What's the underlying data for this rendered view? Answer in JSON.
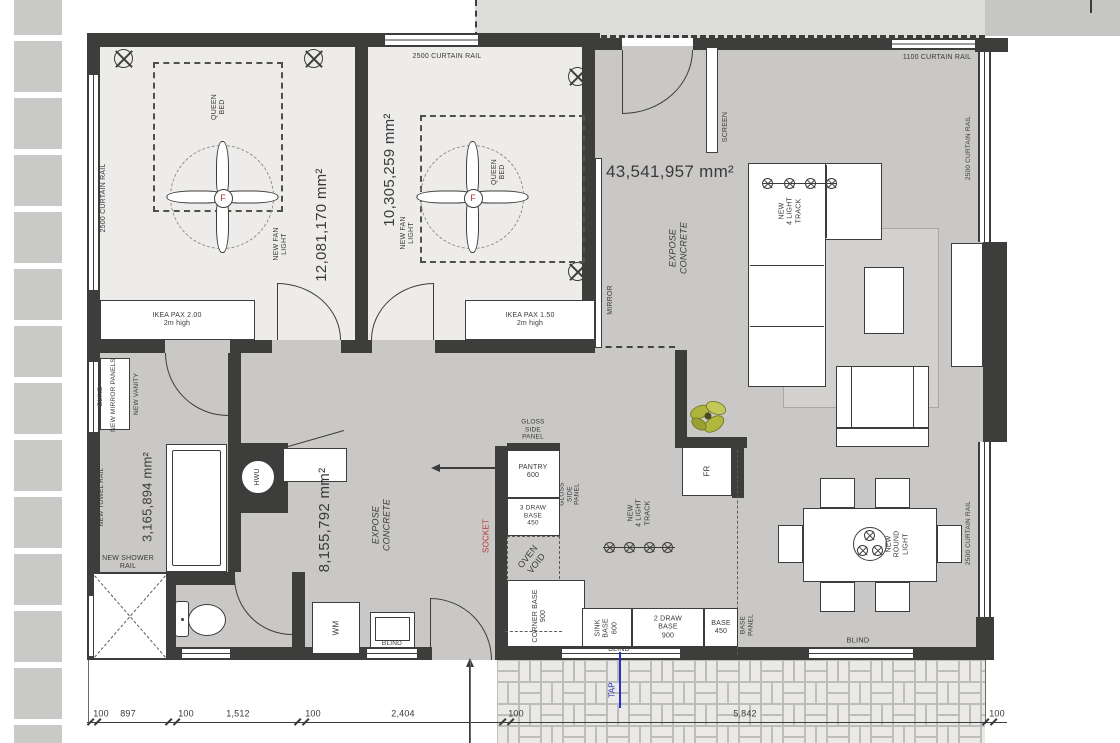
{
  "colors": {
    "wall": "#3d3d3b",
    "floor_main": "#c9c8c6",
    "floor_bedroom": "#edecea",
    "deck": "#dcdcda",
    "accent_red": "#c03330",
    "accent_blue": "#2433c0"
  },
  "rooms": {
    "bedroom1": {
      "area": "12,081,170 mm²",
      "bed": "QUEEN\nBED",
      "fan_label": "NEW FAN\nLIGHT",
      "fan_letter": "F",
      "wardrobe": "IKEA PAX 2.00\n2m high",
      "curtain_left": "2500 CURTAIN RAIL"
    },
    "bedroom2": {
      "area": "10,305,259 mm²",
      "bed": "QUEEN\nBED",
      "fan_label": "NEW FAN\nLIGHT",
      "fan_letter": "F",
      "wardrobe": "IKEA PAX 1.50\n2m high",
      "curtain_top": "2500 CURTAIN RAIL"
    },
    "living": {
      "area": "43,541,957 mm²",
      "finish": "EXPOSE\nCONCRETE",
      "screen": "SCREEN",
      "mirror": "MIRROR",
      "curtain_top": "1100 CURTAIN RAIL",
      "curtain_right_upper": "2500 CURTAIN RAIL",
      "curtain_right_lower": "2500 CURTAIN RAIL",
      "sofa_track": "NEW\n4 LIGHT\nTRACK",
      "round_light": "NEW\nROUND\nLIGHT",
      "blind": "BLIND"
    },
    "bathroom": {
      "area": "3,165,894 mm²",
      "blind": "BLIND",
      "mirror_panels": "NEW MIRROR PANELS",
      "vanity": "NEW VANITY",
      "towel_rail": "NEW TOWEL RAIL",
      "shower_rail": "NEW SHOWER\nRAIL",
      "hwu": "HWU"
    },
    "hall": {
      "area": "8,155,792 mm²",
      "finish": "EXPOSE\nCONCRETE",
      "socket": "SOCKET",
      "wm": "WM",
      "blind": "BLIND"
    },
    "kitchen": {
      "gloss_panel_top": "GLOSS\nSIDE\nPANEL",
      "pantry": "PANTRY\n600",
      "drawer3": "3 DRAW\nBASE\n450",
      "gloss_panel_side": "GLOSS\nSIDE\nPANEL",
      "oven": "OVEN\nVOID",
      "corner_base": "CORNER BASE\n900",
      "sink_base": "SINK\nBASE\n600",
      "drawer2": "2 DRAW\nBASE\n900",
      "base_450": "BASE\n450",
      "base_panel": "BASE\nPANEL",
      "track": "NEW\n4 LIGHT\nTRACK",
      "fridge": "FR",
      "blind": "BLIND",
      "tap": "TAP"
    }
  },
  "dimensions": {
    "values": [
      "100",
      "897",
      "100",
      "1,512",
      "100",
      "2,404",
      "100",
      "5,842",
      "100"
    ]
  }
}
